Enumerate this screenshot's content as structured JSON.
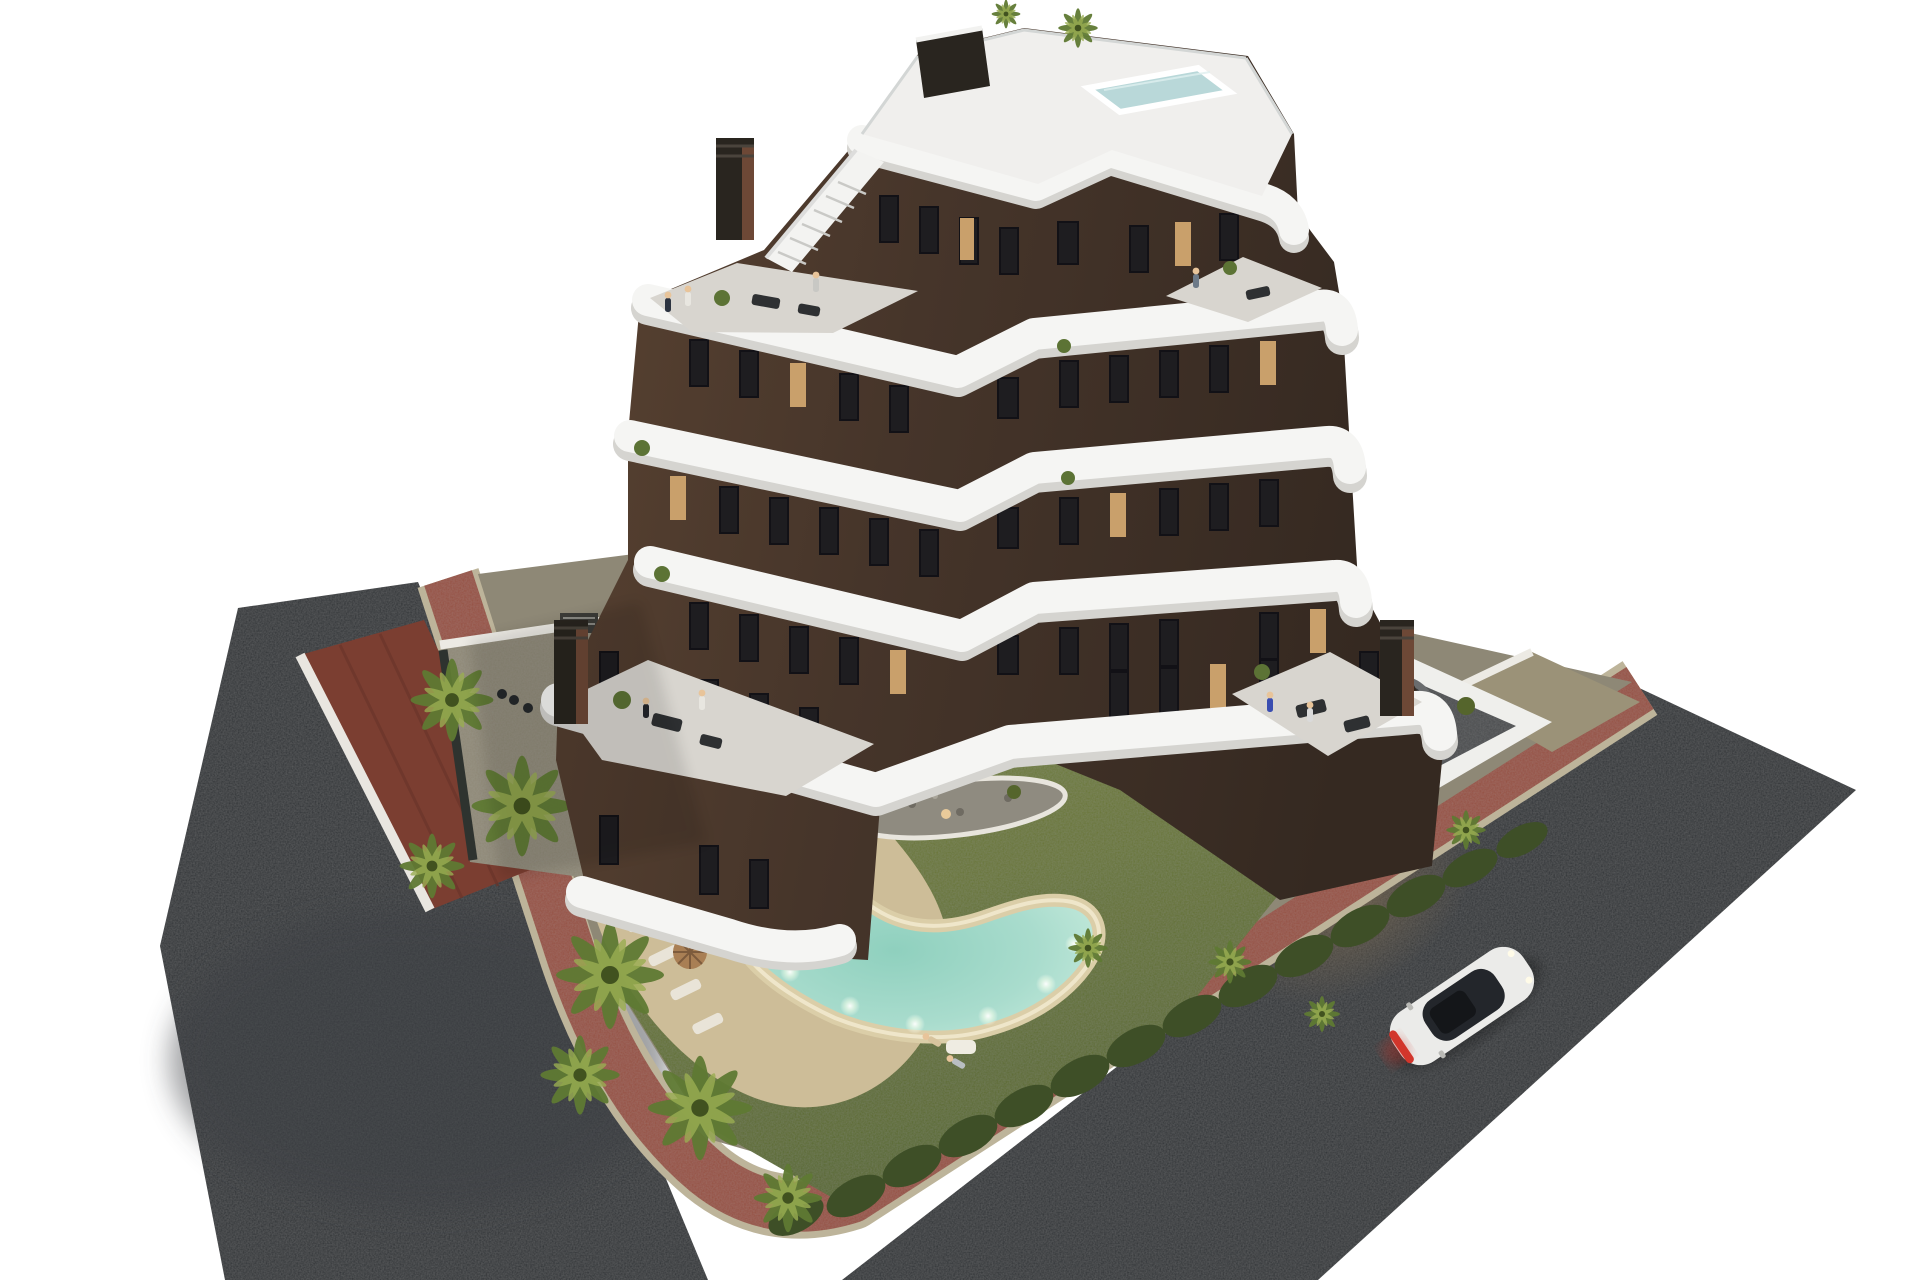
{
  "meta": {
    "type": "3d-architectural-render",
    "subject": "Aerial dusk view of a modern white-and-brown apartment building with zig-zag balcony bands, rooftop plunge pool, landscaped garden, free-form lit swimming pool, palm trees, terracotta sidewalks, asphalt roads and a white car",
    "background_label": "white studio background"
  },
  "colors": {
    "background": "#ffffff",
    "asphalt": "#2f3235",
    "asphalt_light": "#3a3e41",
    "sidewalk": "#95503f",
    "curb": "#bdb49a",
    "lawn": "#6e7a38",
    "lawn_dark": "#55652c",
    "hedge": "#3e4f27",
    "palm": "#5f7a33",
    "palm_light": "#9aae52",
    "trunk": "#8b7a5c",
    "deck": "#cdbd98",
    "pebble": "#8f8b80",
    "pool_rim": "#dbcea8",
    "pool_water": "#a9dccd",
    "facade": "#4a382c",
    "facade_dark": "#382b22",
    "band_white": "#f5f5f3",
    "band_shadow": "#d5d4d0",
    "roof_deck": "#f0efed",
    "rooftop_pool": "#b9d8d9",
    "terrace_floor": "#d8d5cf",
    "terrace_tile": "#46494c",
    "courtyard": "#8e8876",
    "driveway": "#9b9278",
    "neighbor_roof": "#7b3e31",
    "chimney": "#29251f",
    "chimney_rust": "#6d4836",
    "window": "#1e1d20",
    "window_lit": "#c9a06b",
    "furniture_dark": "#2e3032",
    "furniture_light": "#e6e4de",
    "car_body": "#ebebe9",
    "car_glass": "#23262b",
    "car_tail": "#d2362c",
    "umbrella": "#a97f54",
    "skin": "#e8c49a",
    "wall_white": "#eceae4"
  },
  "scene": {
    "building": {
      "label": "apartment building",
      "visible_floor_bands": 6,
      "rooftop": "roof terrace with plunge pool, stair and dark pergola",
      "chimneys": 3
    },
    "garden": {
      "label": "private garden",
      "features": "lawn, pebble island with large palm, hedges, palm clusters"
    },
    "pool": {
      "label": "free-form swimming pool",
      "state": "underwater lights on",
      "loungers": 5,
      "umbrellas": 2
    },
    "terrace": {
      "label": "ground floor walled terrace",
      "furniture": "dining table, lounge sofas, round rug with chairs"
    },
    "roads": {
      "left": "asphalt street",
      "right": "asphalt street with white car",
      "sidewalk": "terracotta paved walkway with stone curb"
    },
    "car": {
      "label": "white coupe",
      "detail": "red tail-light bar lit"
    }
  }
}
